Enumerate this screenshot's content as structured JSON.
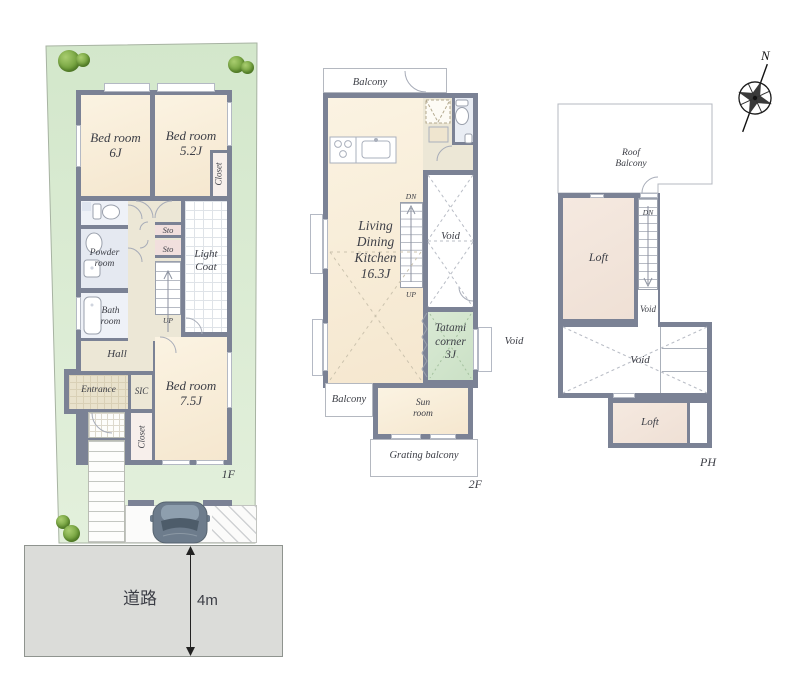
{
  "compass": {
    "north_label": "N"
  },
  "site": {
    "road_label": "道路",
    "road_width_label": "4m"
  },
  "floor1": {
    "floor_label": "1F",
    "rooms": {
      "bedroom6": "Bed room\n6J",
      "bedroom52": "Bed room\n5.2J",
      "closet52": "Closet",
      "powder": "Powder\nroom",
      "bath": "Bath\nroom",
      "sto_upper": "Sto",
      "sto_lower": "Sto",
      "stairs_up": "UP",
      "light_coat": "Light\nCoat",
      "hall": "Hall",
      "entrance": "Entrance",
      "sic": "SIC",
      "closet75": "Closet",
      "bedroom75": "Bed room\n7.5J"
    }
  },
  "floor2": {
    "floor_label": "2F",
    "rooms": {
      "balcony_top": "Balcony",
      "ldk": "Living\nDining\nKitchen\n16.3J",
      "stairs_dn": "DN",
      "stairs_up": "UP",
      "void_upper": "Void",
      "tatami": "Tatami\ncorner\n3J",
      "void_side": "Void",
      "balcony_bottom": "Balcony",
      "sun_room": "Sun\nroom",
      "grating_balcony": "Grating balcony"
    }
  },
  "floor_ph": {
    "floor_label": "PH",
    "rooms": {
      "roof_balcony": "Roof\nBalcony",
      "loft_upper": "Loft",
      "stairs_dn": "DN",
      "void_stairs": "Void",
      "void_center": "Void",
      "loft_lower": "Loft"
    }
  },
  "colors": {
    "lawn": "#d5e8ce",
    "wall": "#7b8295",
    "tatami-c": "#d3e6cf",
    "loft-c": "#f2e5dc",
    "cream-c": "#f8eed9",
    "road-c": "#dbdcd9"
  }
}
